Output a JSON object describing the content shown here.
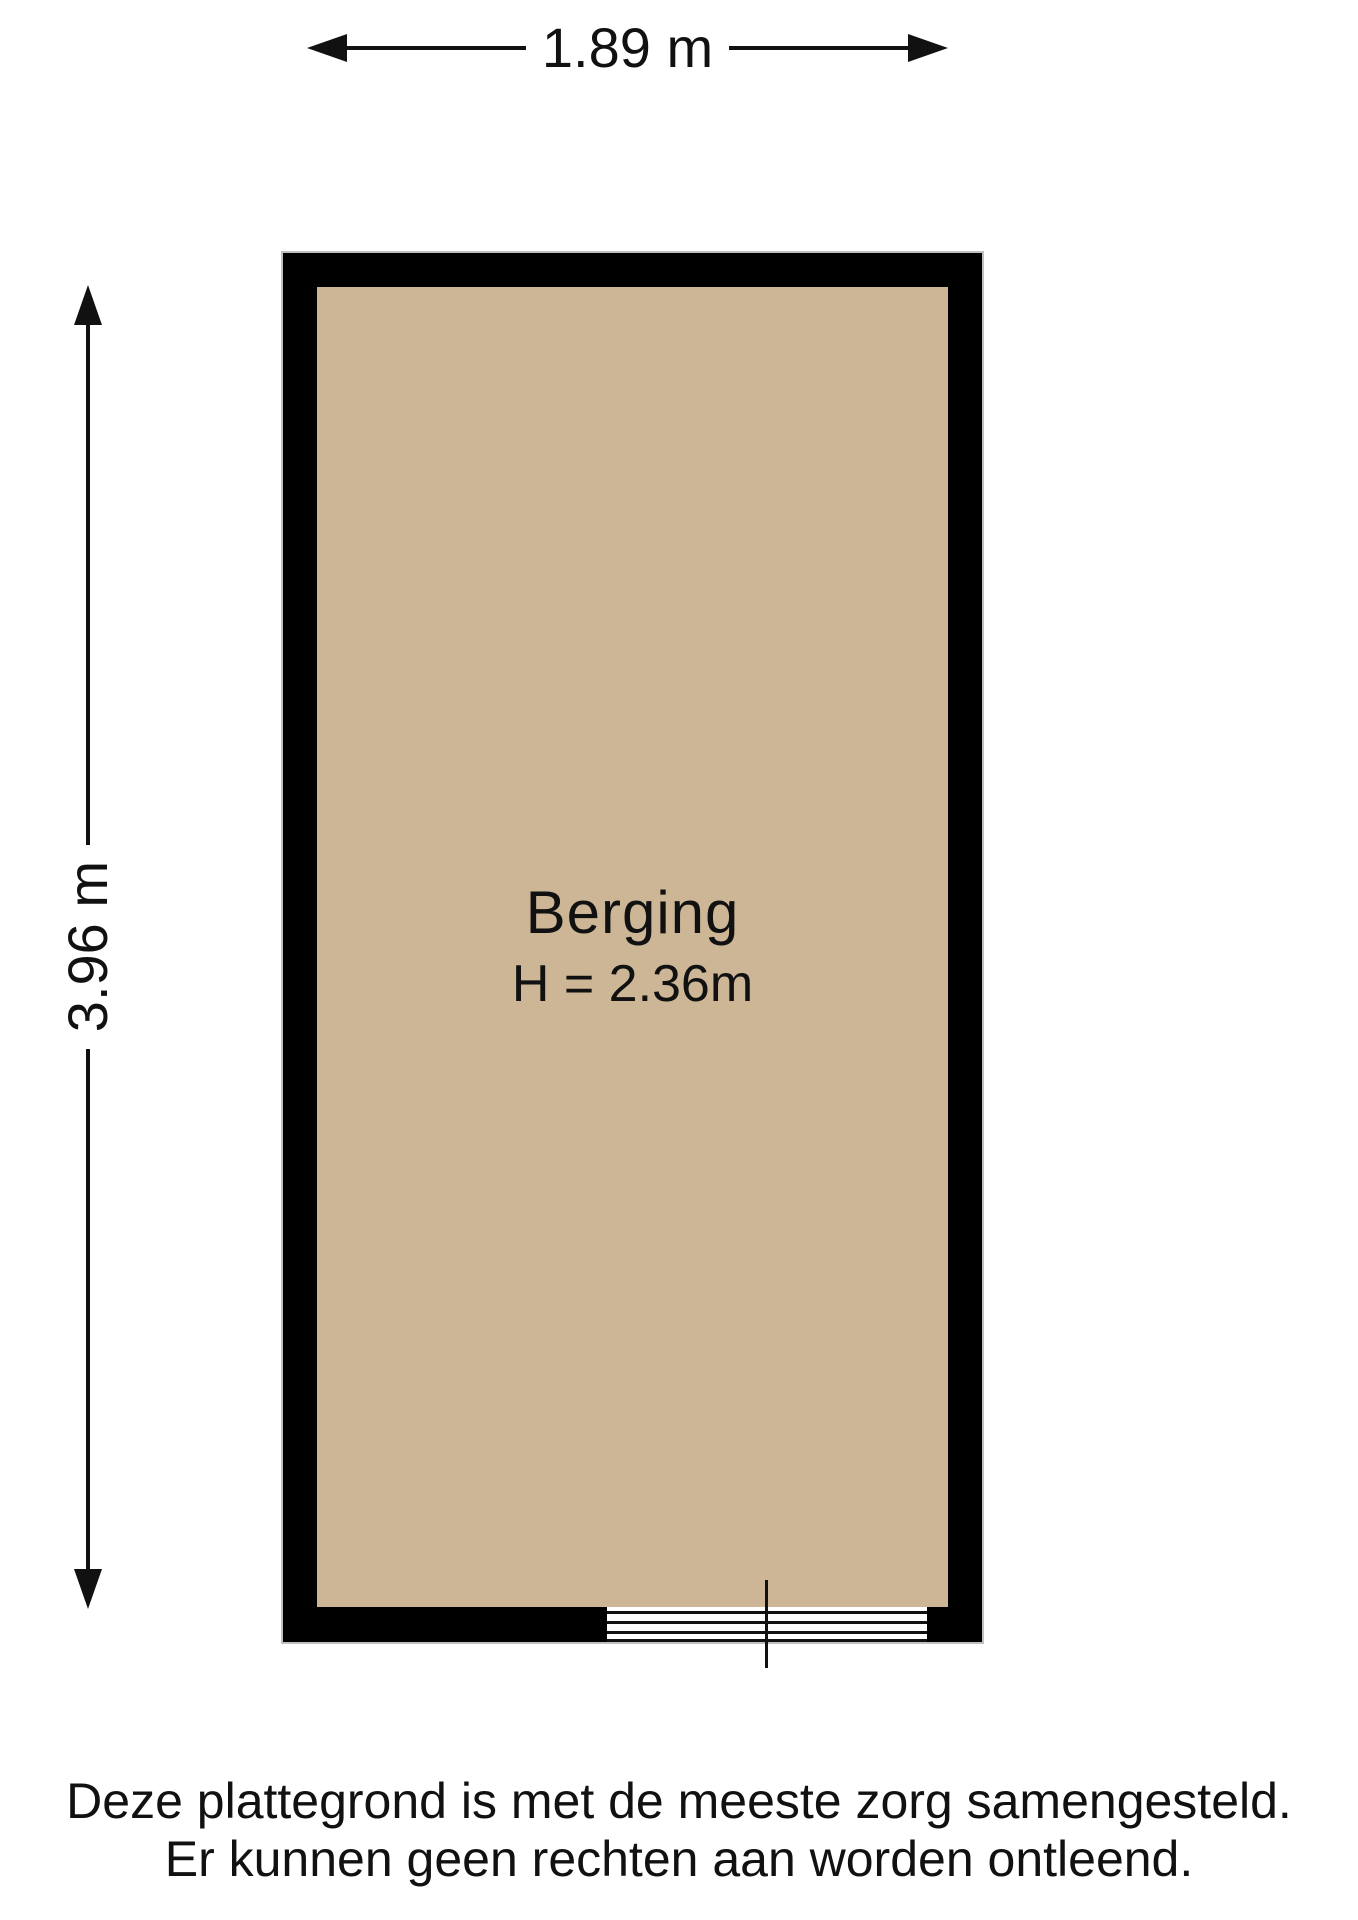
{
  "floorplan": {
    "dimensions": {
      "width_label": "1.89 m",
      "height_label": "3.96 m"
    },
    "room": {
      "name": "Berging",
      "ceiling_height": "H = 2.36m"
    },
    "disclaimer": {
      "line1": "Deze plattegrond is met de meeste zorg samengesteld.",
      "line2": "Er kunnen geen rechten aan worden ontleend."
    },
    "colors": {
      "wall": "#000000",
      "floor": "#cdb696",
      "background": "#ffffff",
      "ink": "#111111"
    }
  }
}
